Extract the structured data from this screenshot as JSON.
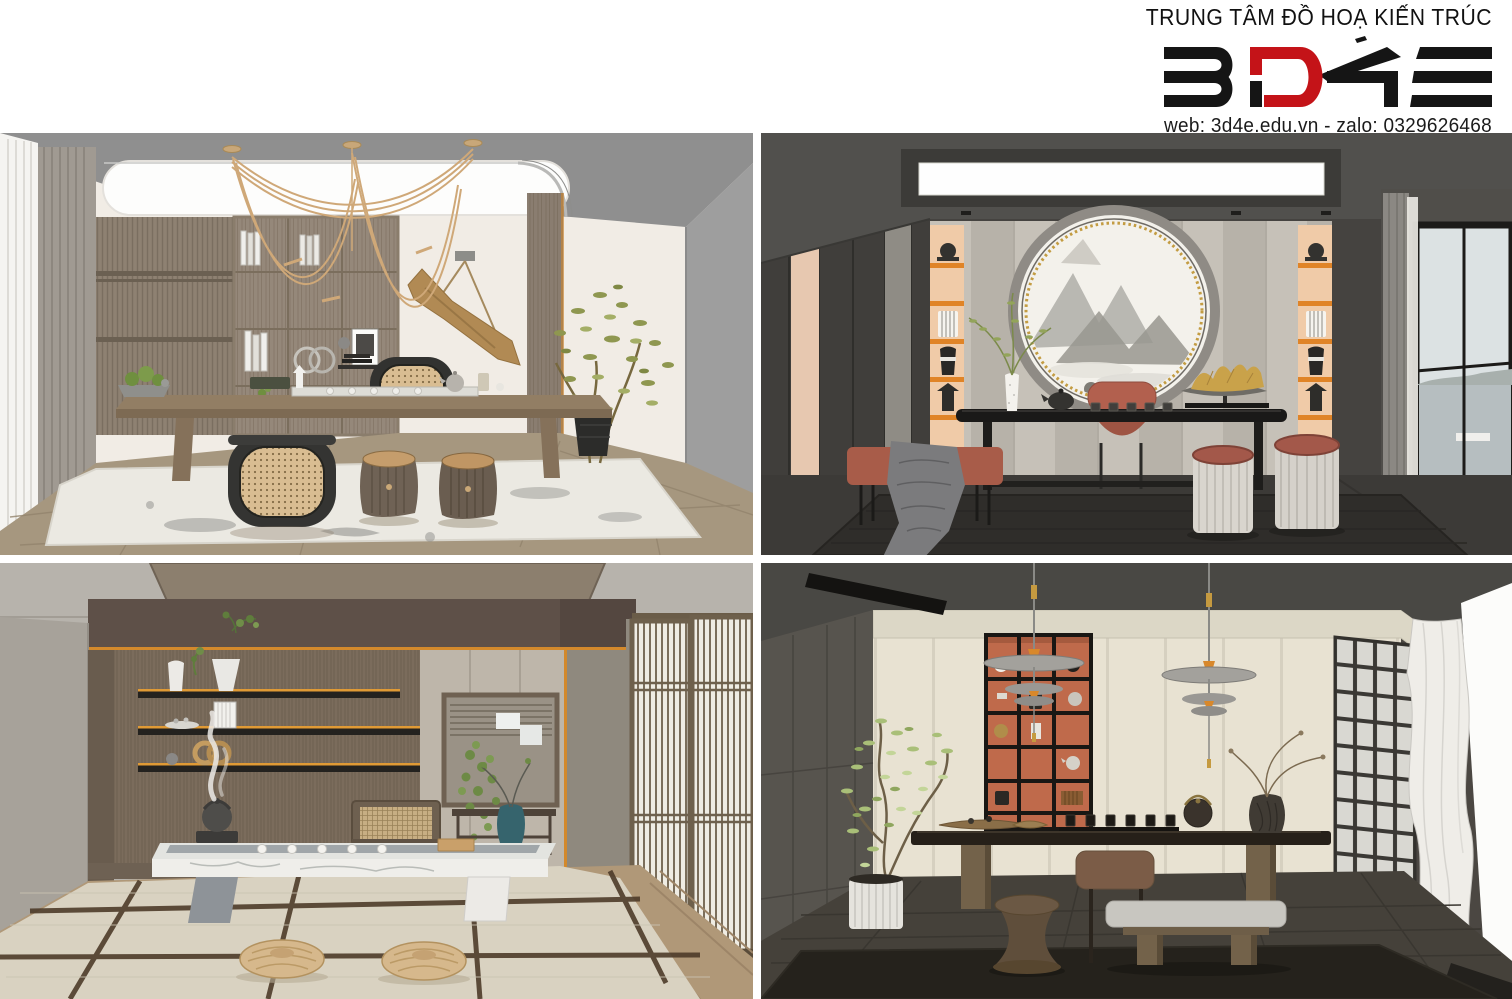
{
  "header": {
    "title": "TRUNG TÂM ĐỒ HOẠ KIẾN TRÚC",
    "logo_text": "3D4E",
    "contact": "web: 3d4e.edu.vn - zalo: 0329626468"
  },
  "palette": {
    "brand_black": "#161616",
    "brand_red": "#c41318",
    "accent_orange": "#e08427",
    "terracotta_shelf": "#bf6a4b",
    "peach_niche": "#f0cba8",
    "cream_wall": "#f1ece5",
    "warm_wood": "#8f8172",
    "dark_wall": "#4e4d4b",
    "tatami": "#d9d2c1",
    "rattan": "#d9bd92"
  },
  "panels": [
    {
      "id": "top-left",
      "alt": "Light tea study: wood bookshelf wall, rope pendant light, long wood tea table, rattan barrel chairs, woven stools, olive plant"
    },
    {
      "id": "top-right",
      "alt": "Dark tea room: round landscape art niche, orange-lit display columns, black tea table, red chair and bench, fluted ottomans, lake window"
    },
    {
      "id": "bottom-left",
      "alt": "Japanese tatami tea room: brown wall with orange-trim shelves, low marble tea table with kettle, shoji screens, rattan floor cushions"
    },
    {
      "id": "bottom-right",
      "alt": "Modern dark tea space: terracotta shelf niche, disc pendant lamps, long dark wood table, glass-block screen and flowing white curtain"
    }
  ]
}
